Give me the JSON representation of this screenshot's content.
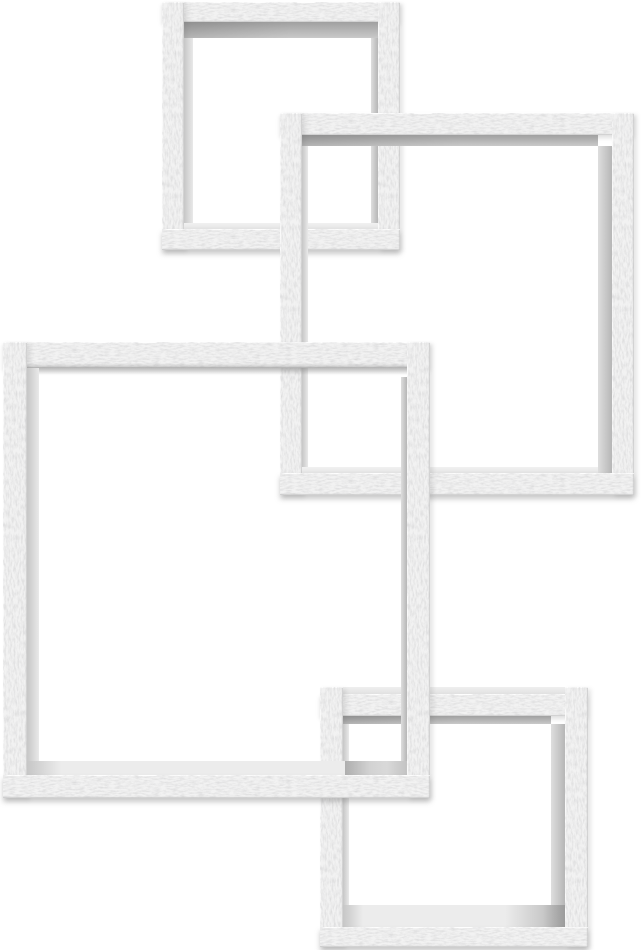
{
  "image": {
    "kind": "product-photo",
    "description": "Set of four interlocking square floating wall shelves in a distressed white-washed rustic wood finish, shown on a plain white background",
    "background_color": "#ffffff"
  },
  "product": {
    "name": "Interlocking cube wall shelf set",
    "piece_count": "4",
    "finish": "Distressed rustic white / gray whitewash"
  },
  "palette": {
    "background": "#ffffff",
    "wood_base": "#f2f2f2",
    "wood_speckle": "#8c8c8c",
    "inner_top_wall": "#a0a0a0",
    "inner_side_wall_light": "#d6d6d6",
    "inner_side_wall_dark": "#b6b6b6",
    "shelf_surface": "#ececec",
    "drop_shadow": "rgba(115,115,115,0.38)"
  },
  "frames": [
    {
      "id": "top-left",
      "label": "Small square shelf cube, top left"
    },
    {
      "id": "top-right",
      "label": "Large square shelf cube, top right"
    },
    {
      "id": "middle-left",
      "label": "Large square shelf cube, middle left"
    },
    {
      "id": "bottom-right",
      "label": "Small square shelf cube, bottom right"
    }
  ]
}
